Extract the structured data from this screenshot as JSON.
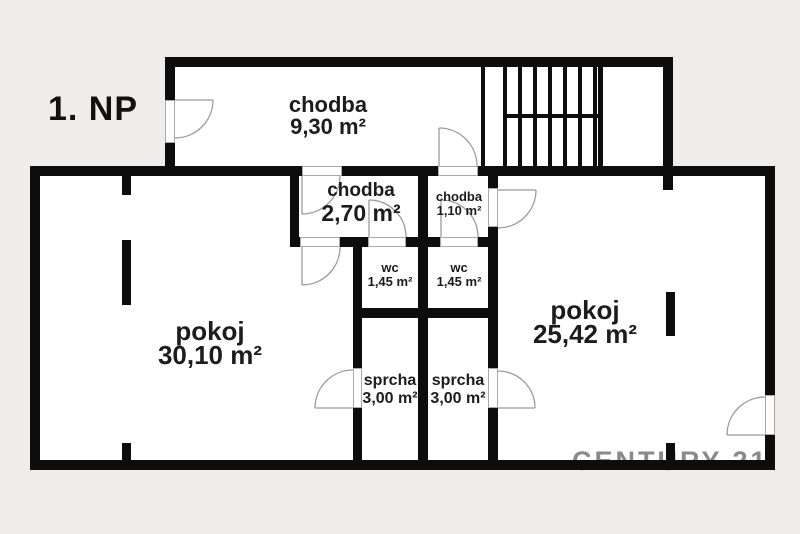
{
  "meta": {
    "floor_label": "1. NP",
    "watermark": "CENTURY 21."
  },
  "colors": {
    "background": "#efedeb",
    "floor": "#ffffff",
    "wall": "#0d0d0d",
    "door_line": "#9a9a9a",
    "watermark": "#8a8a8a",
    "text": "#1c1c1c"
  },
  "rooms": [
    {
      "id": "chodba-top",
      "name": "chodba",
      "area": "9,30 m²"
    },
    {
      "id": "chodba-mid",
      "name": "chodba",
      "area": "2,70 m²"
    },
    {
      "id": "chodba-small",
      "name": "chodba",
      "area": "1,10 m²"
    },
    {
      "id": "wc-left",
      "name": "wc",
      "area": "1,45 m²"
    },
    {
      "id": "wc-right",
      "name": "wc",
      "area": "1,45 m²"
    },
    {
      "id": "sprcha-left",
      "name": "sprcha",
      "area": "3,00 m²"
    },
    {
      "id": "sprcha-right",
      "name": "sprcha",
      "area": "3,00 m²"
    },
    {
      "id": "pokoj-left",
      "name": "pokoj",
      "area": "30,10 m²"
    },
    {
      "id": "pokoj-right",
      "name": "pokoj",
      "area": "25,42 m²"
    }
  ]
}
